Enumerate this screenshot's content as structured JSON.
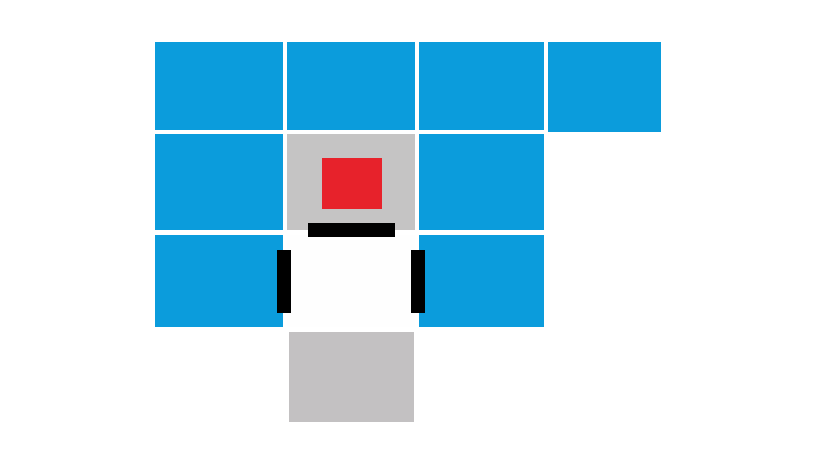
{
  "scene": {
    "background": "#ffffff",
    "board_width": 819,
    "board_height": 460
  },
  "colors": {
    "wall_blue": "#0b9cdc",
    "pad_gray": "#c5c4c4",
    "floor_gray": "#c3c1c2",
    "button_red": "#e7222b",
    "mark_black": "#000000",
    "player_white": "#fefefe"
  },
  "board": {
    "tiles": [
      {
        "name": "wall-tile-r1c1",
        "type": "wall",
        "color": "wall_blue",
        "x": 155,
        "y": 42,
        "w": 128,
        "h": 88,
        "interactable": "false"
      },
      {
        "name": "wall-tile-r1c2",
        "type": "wall",
        "color": "wall_blue",
        "x": 287,
        "y": 42,
        "w": 128,
        "h": 88,
        "interactable": "false"
      },
      {
        "name": "wall-tile-r1c3",
        "type": "wall",
        "color": "wall_blue",
        "x": 419,
        "y": 42,
        "w": 125,
        "h": 88,
        "interactable": "false"
      },
      {
        "name": "wall-tile-r1c4",
        "type": "wall",
        "color": "wall_blue",
        "x": 548,
        "y": 42,
        "w": 113,
        "h": 90,
        "interactable": "false"
      },
      {
        "name": "wall-tile-r2c1",
        "type": "wall",
        "color": "wall_blue",
        "x": 155,
        "y": 134,
        "w": 128,
        "h": 96,
        "interactable": "false"
      },
      {
        "name": "button-pad-tile",
        "type": "pad",
        "color": "pad_gray",
        "x": 287,
        "y": 134,
        "w": 128,
        "h": 96,
        "interactable": "true"
      },
      {
        "name": "wall-tile-r2c3",
        "type": "wall",
        "color": "wall_blue",
        "x": 419,
        "y": 134,
        "w": 125,
        "h": 96,
        "interactable": "false"
      },
      {
        "name": "wall-tile-r3c1",
        "type": "wall",
        "color": "wall_blue",
        "x": 155,
        "y": 235,
        "w": 128,
        "h": 92,
        "interactable": "false"
      },
      {
        "name": "player-tile",
        "type": "player",
        "color": "player_white",
        "x": 287,
        "y": 235,
        "w": 128,
        "h": 92,
        "interactable": "true"
      },
      {
        "name": "wall-tile-r3c3",
        "type": "wall",
        "color": "wall_blue",
        "x": 419,
        "y": 235,
        "w": 125,
        "h": 92,
        "interactable": "false"
      },
      {
        "name": "floor-tile-r4c2",
        "type": "floor",
        "color": "floor_gray",
        "x": 289,
        "y": 332,
        "w": 125,
        "h": 90,
        "interactable": "false"
      }
    ],
    "marks": [
      {
        "name": "red-button",
        "color": "button_red",
        "x": 322,
        "y": 158,
        "w": 60,
        "h": 51,
        "interactable": "true"
      },
      {
        "name": "player-top-bar",
        "color": "mark_black",
        "x": 308,
        "y": 223,
        "w": 87,
        "h": 14,
        "interactable": "false"
      },
      {
        "name": "player-left-bar",
        "color": "mark_black",
        "x": 277,
        "y": 250,
        "w": 14,
        "h": 63,
        "interactable": "false"
      },
      {
        "name": "player-right-bar",
        "color": "mark_black",
        "x": 411,
        "y": 250,
        "w": 14,
        "h": 63,
        "interactable": "false"
      }
    ]
  }
}
